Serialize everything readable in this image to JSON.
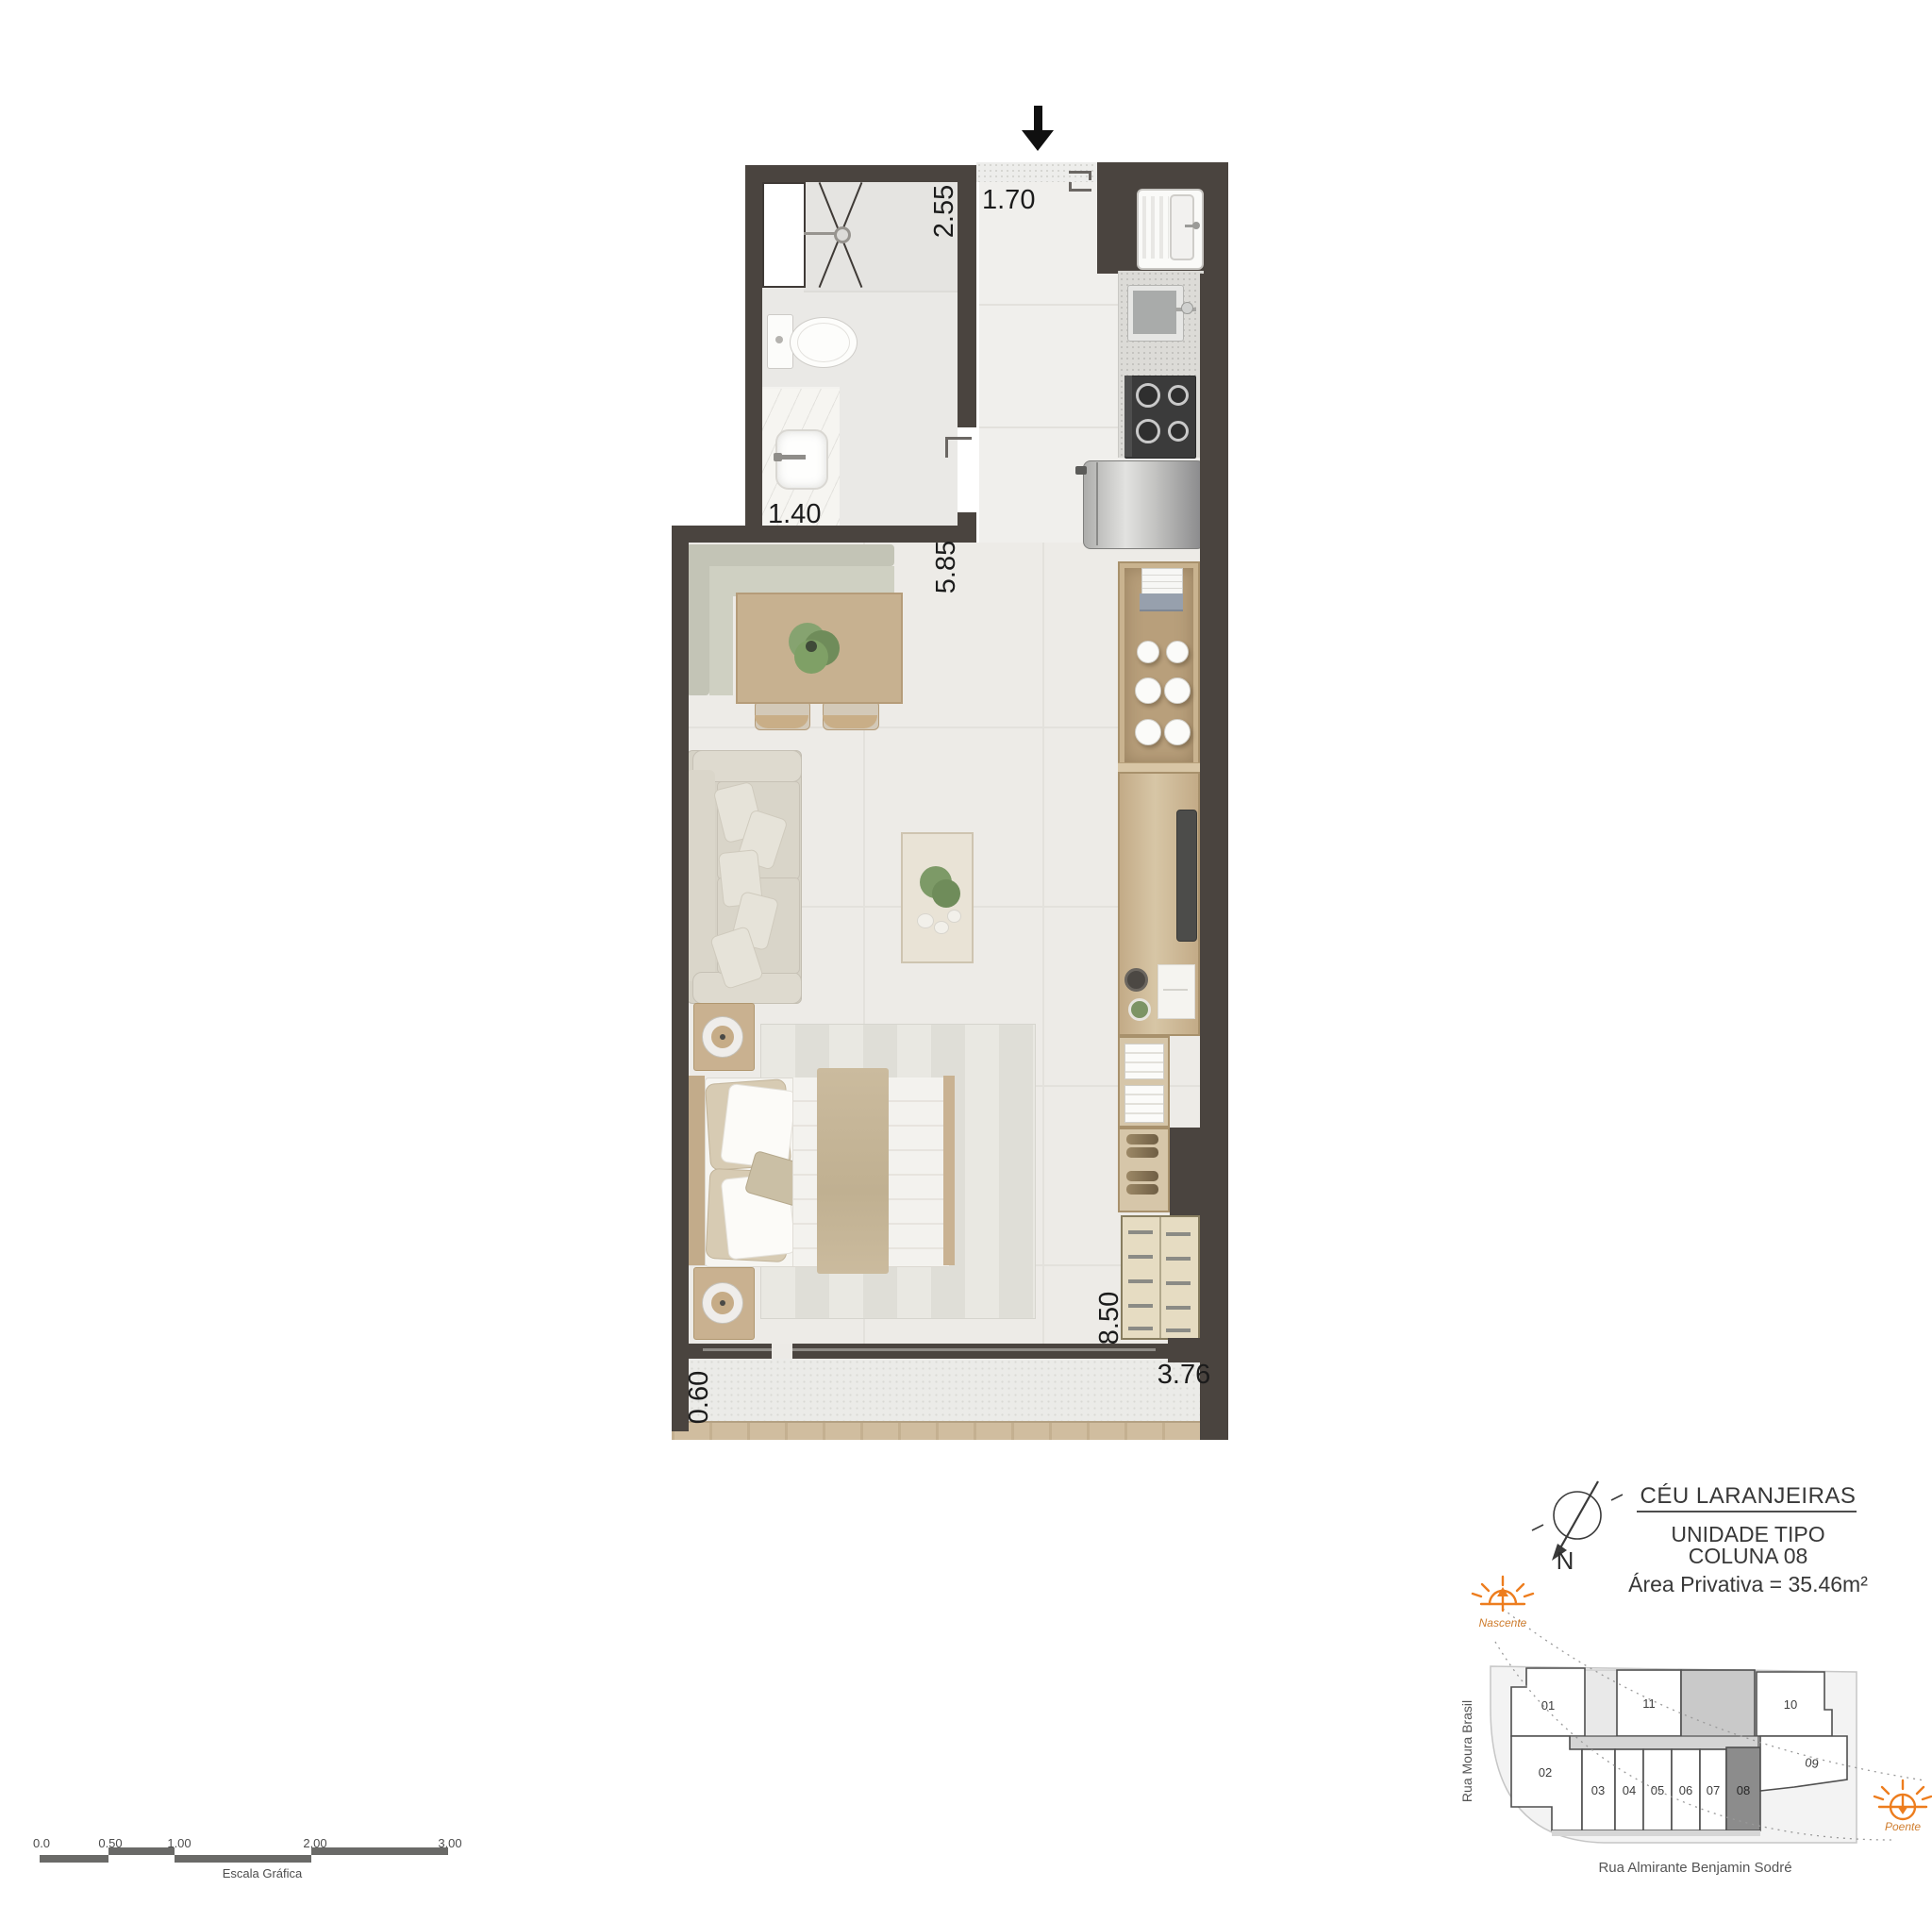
{
  "plan": {
    "dimensions": {
      "bathroom_length": "2.55",
      "entry_width": "1.70",
      "bathroom_width": "1.40",
      "kitchen_length": "5.85",
      "living_length": "8.50",
      "balcony_depth": "0.60",
      "balcony_width": "3.76"
    }
  },
  "scale_bar": {
    "ticks": [
      "0.0",
      "0.50",
      "1.00",
      "2.00",
      "3.00"
    ],
    "label": "Escala Gráfica"
  },
  "title_block": {
    "project": "CÉU LARANJEIRAS",
    "unit_type": "UNIDADE TIPO",
    "unit_column": "COLUNA 08",
    "private_area": "Área Privativa = 35.46m²",
    "north_label": "N"
  },
  "key_plan": {
    "units": [
      "01",
      "02",
      "03",
      "04",
      "05",
      "06",
      "07",
      "08",
      "09",
      "10",
      "11"
    ],
    "highlighted_unit": "08",
    "streets": {
      "west": "Rua Moura Brasil",
      "south": "Rua Almirante Benjamin Sodré"
    },
    "sun": {
      "east": "Nascente",
      "west": "Poente"
    }
  },
  "icons": {
    "entrance": "arrow-down",
    "north": "compass-needle",
    "nascente": "rising-sun",
    "poente": "setting-sun"
  },
  "colors": {
    "wall": "#4A443F",
    "sun_accent": "#ED7D1E",
    "unit_highlight_fill": "#8C8C8C",
    "wood": "#CBB292"
  }
}
